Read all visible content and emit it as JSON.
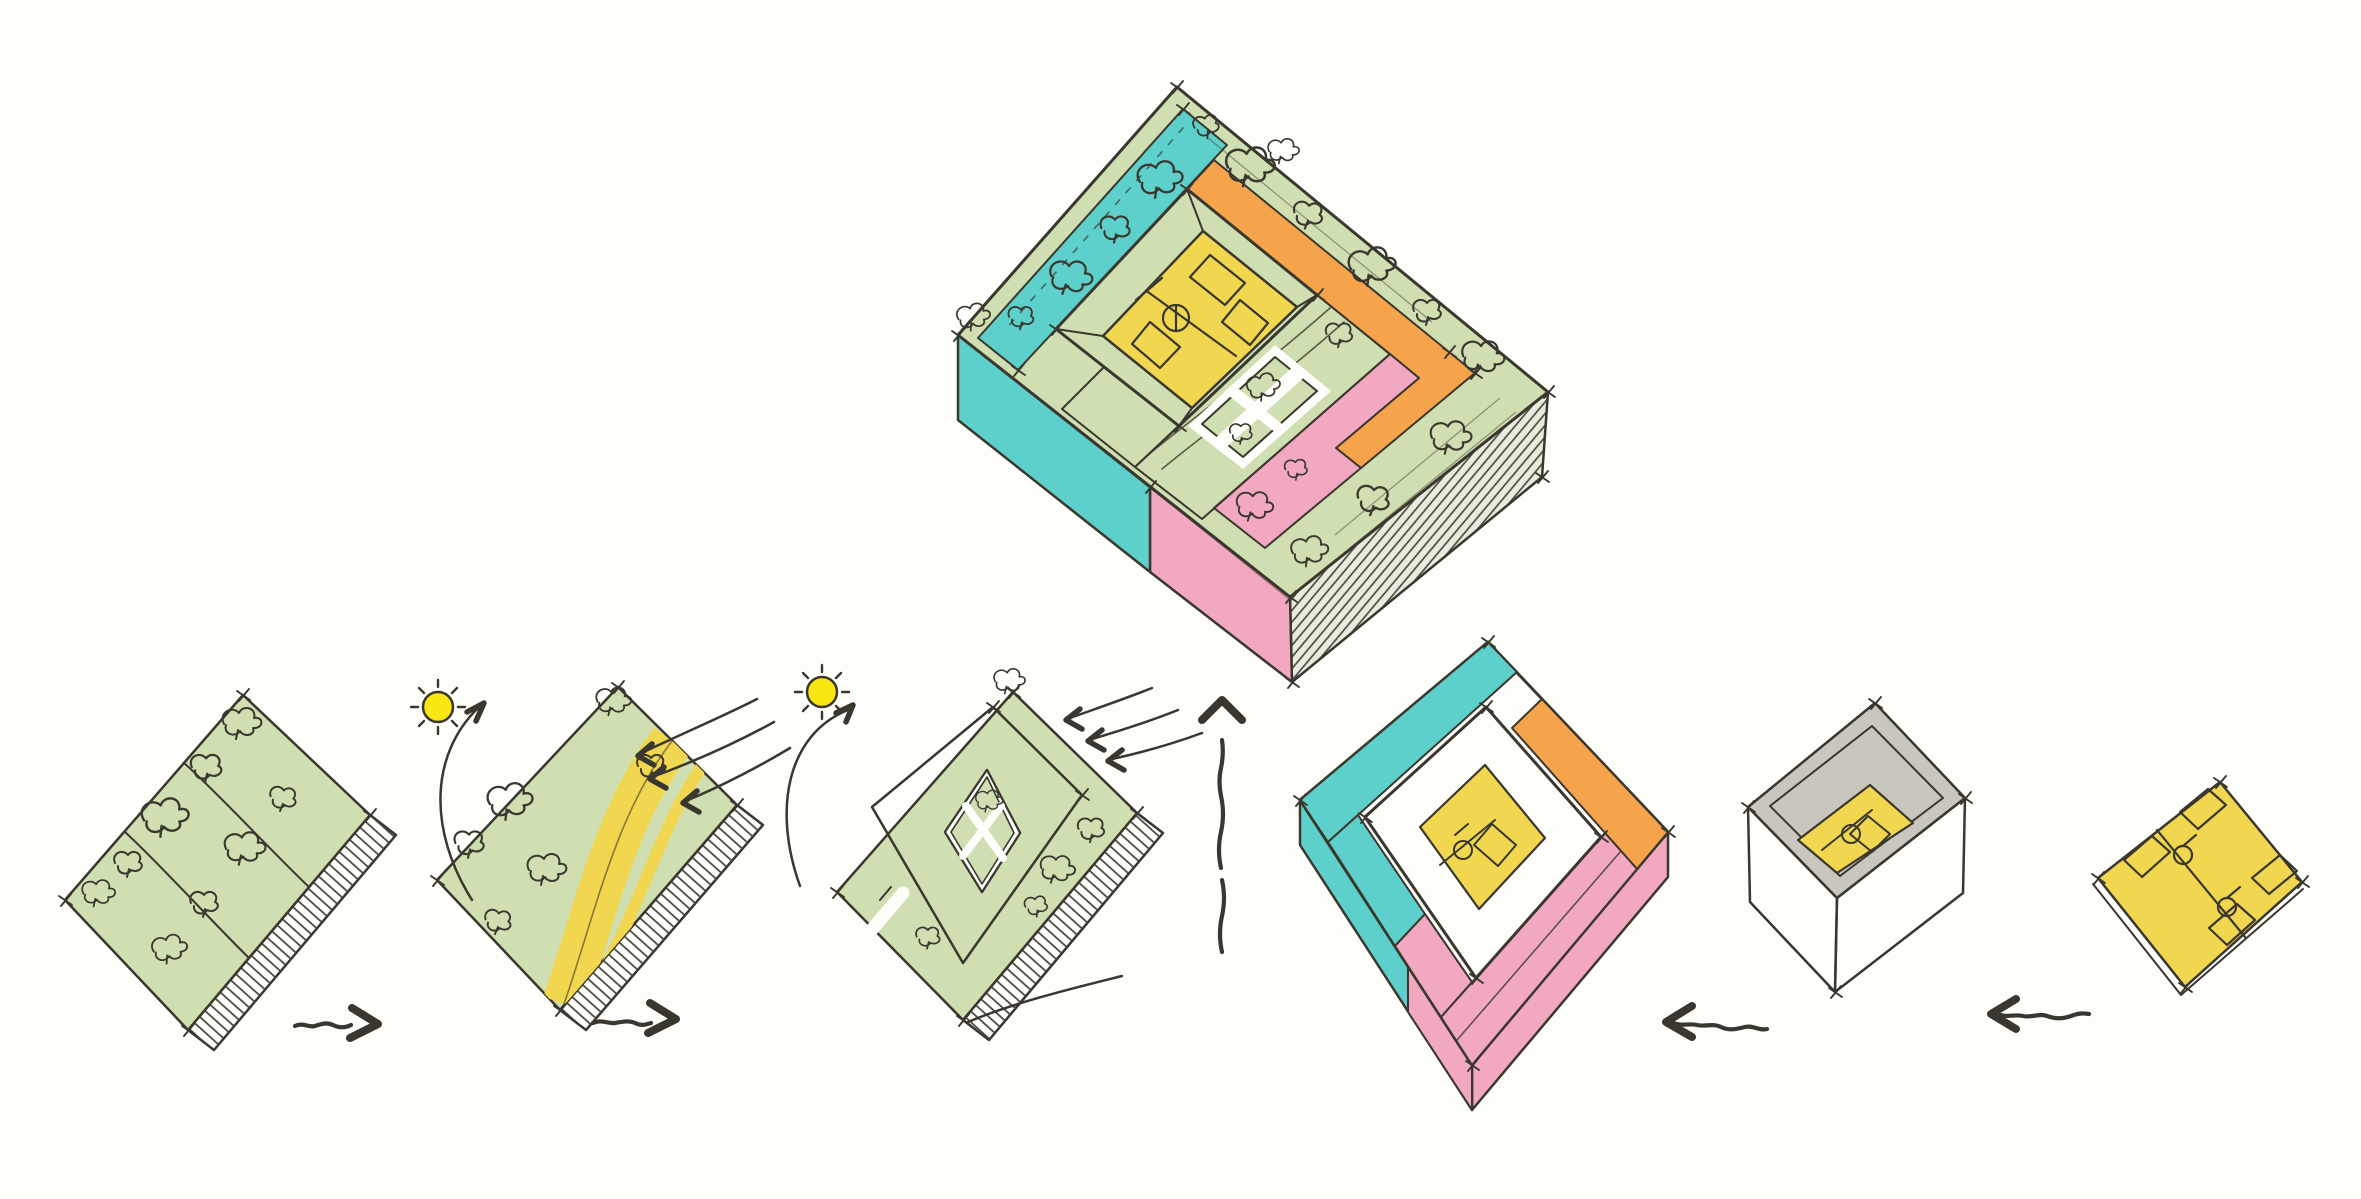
{
  "canvas": {
    "width": 2361,
    "height": 1199,
    "background_color": "#fdfdfa"
  },
  "palette": {
    "ink": "#3a372e",
    "sage": "#cfdfb2",
    "teal": "#5ed0cb",
    "orange": "#f6a44c",
    "pink": "#f3a8c1",
    "yellow": "#f1d64f",
    "sand": "#ebd171",
    "sun": "#f8e712",
    "wallGray": "#b6b3a9",
    "rimGray": "#c9c6bd",
    "hatch": "#44413a",
    "paper": "#fdfdfa",
    "faceTint": "#e9ebdd",
    "speck": "#8a7a33"
  },
  "figures": [
    {
      "name": "exploded-concept-building",
      "position": "top-center",
      "colors": [
        "sage",
        "teal",
        "orange",
        "pink",
        "yellow",
        "sand",
        "wallGray"
      ]
    },
    {
      "name": "site-block",
      "position": "bottom-row-1",
      "colors": [
        "sage"
      ]
    },
    {
      "name": "site-sun-wind-block",
      "position": "bottom-row-2",
      "colors": [
        "sage",
        "yellow",
        "sun"
      ]
    },
    {
      "name": "courtyard-building-block",
      "position": "bottom-row-3",
      "colors": [
        "sage",
        "sand",
        "sun"
      ]
    },
    {
      "name": "colored-program-block",
      "position": "bottom-row-4",
      "colors": [
        "teal",
        "orange",
        "pink",
        "yellow",
        "wallGray"
      ]
    },
    {
      "name": "inner-walls-block",
      "position": "bottom-row-5",
      "colors": [
        "wallGray",
        "yellow"
      ]
    },
    {
      "name": "unit-plan",
      "position": "bottom-row-6",
      "colors": [
        "yellow"
      ]
    }
  ],
  "icons": [
    {
      "name": "sun-icon",
      "count": 2,
      "color_key": "sun"
    },
    {
      "name": "arrow-right-icon",
      "count": 2
    },
    {
      "name": "arrow-left-icon",
      "count": 2
    },
    {
      "name": "arrow-up-icon",
      "count": 1
    },
    {
      "name": "wind-arrow-icon",
      "count": 6
    },
    {
      "name": "sun-path-arrow-icon",
      "count": 2
    },
    {
      "name": "tree-scribble-icon",
      "count": 40
    }
  ]
}
